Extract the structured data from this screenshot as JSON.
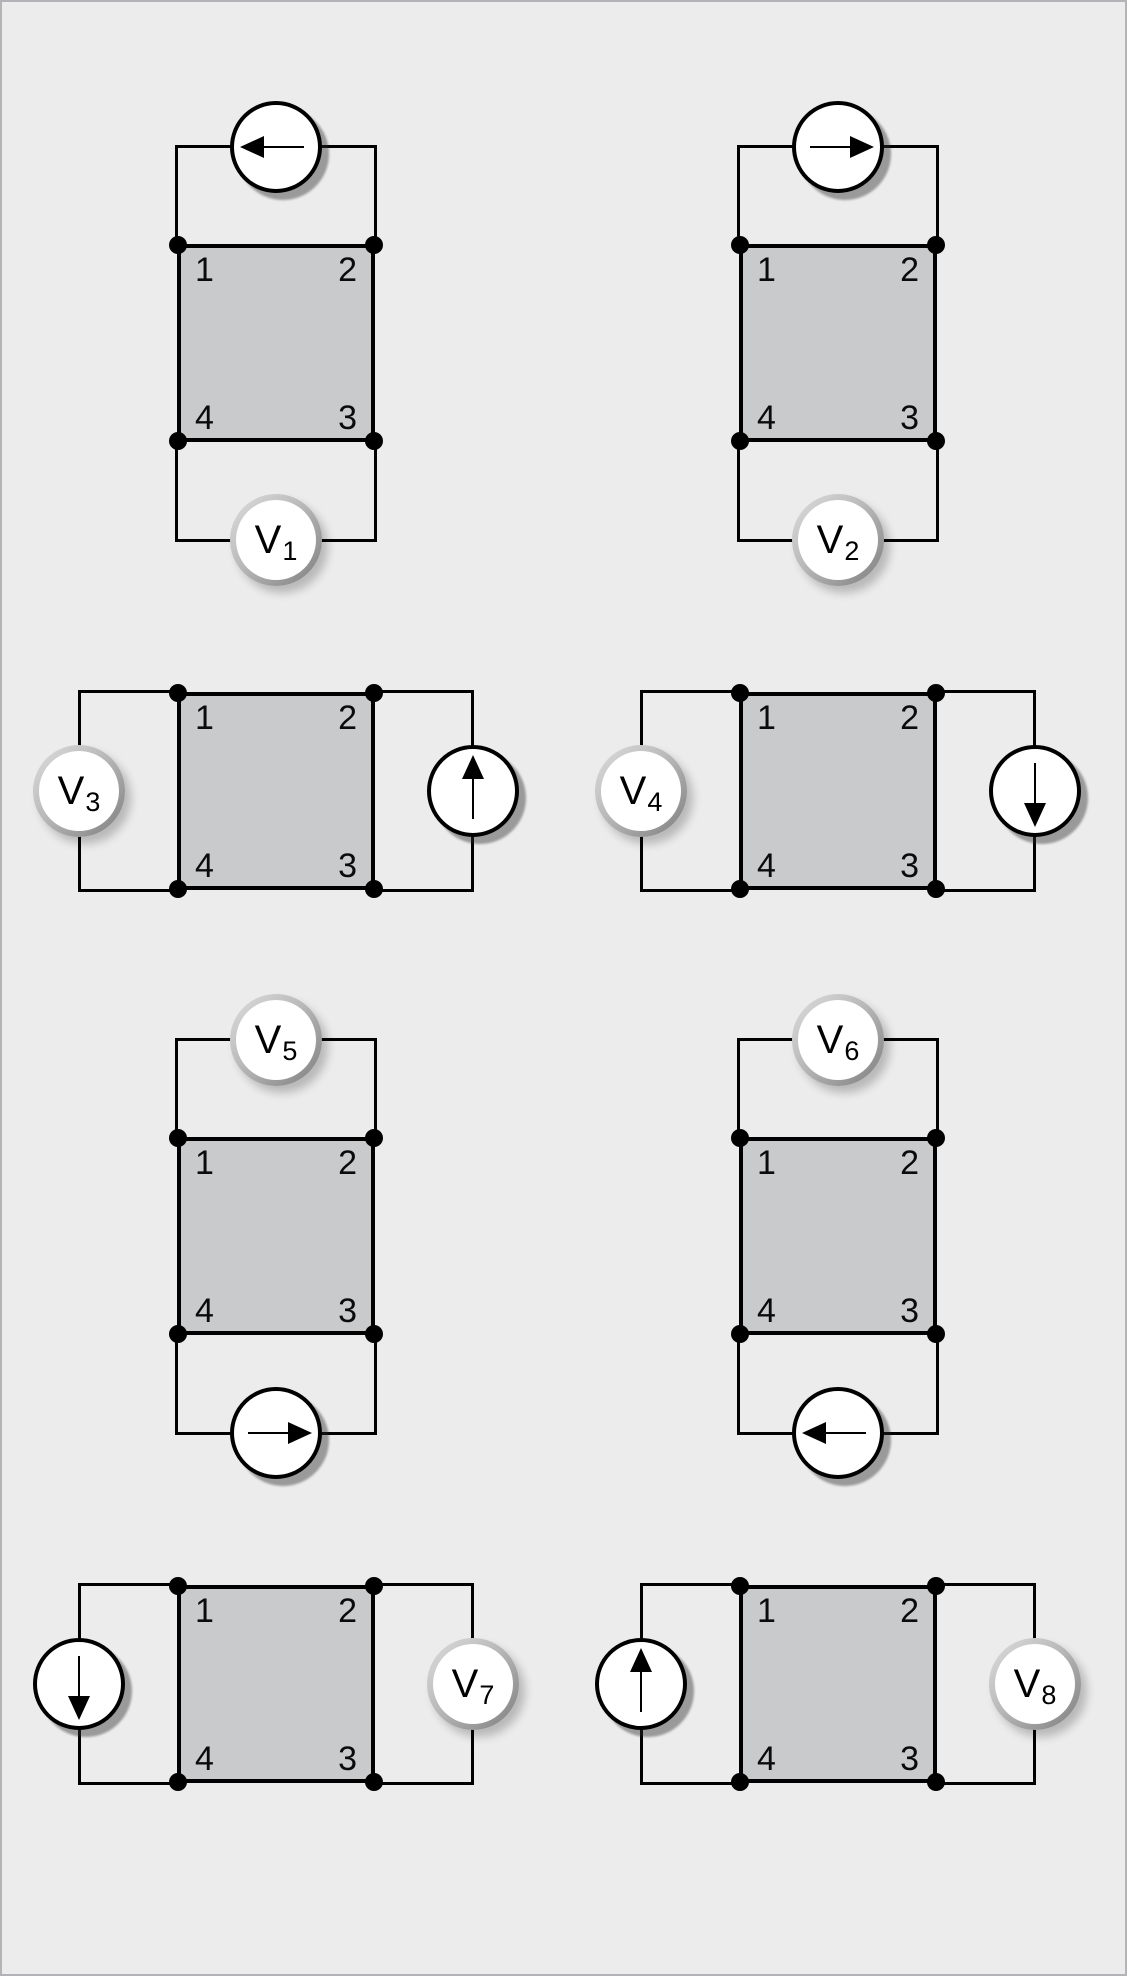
{
  "figure": {
    "type": "van-der-pauw-measurement-configurations",
    "background_color": "#ececec",
    "frame_color": "#b2b4b7",
    "sample_fill_color": "#c9cacb",
    "wire_color": "#000000"
  },
  "diagrams": [
    {
      "name": "config-1",
      "corners": {
        "tl": "1",
        "tr": "2",
        "br": "3",
        "bl": "4"
      },
      "voltmeter": {
        "label": "V",
        "sub": "1",
        "position": "bottom"
      },
      "current_source": {
        "position": "top",
        "arrow_direction": "left"
      }
    },
    {
      "name": "config-2",
      "corners": {
        "tl": "1",
        "tr": "2",
        "br": "3",
        "bl": "4"
      },
      "voltmeter": {
        "label": "V",
        "sub": "2",
        "position": "bottom"
      },
      "current_source": {
        "position": "top",
        "arrow_direction": "right"
      }
    },
    {
      "name": "config-3",
      "corners": {
        "tl": "1",
        "tr": "2",
        "br": "3",
        "bl": "4"
      },
      "voltmeter": {
        "label": "V",
        "sub": "3",
        "position": "left"
      },
      "current_source": {
        "position": "right",
        "arrow_direction": "up"
      }
    },
    {
      "name": "config-4",
      "corners": {
        "tl": "1",
        "tr": "2",
        "br": "3",
        "bl": "4"
      },
      "voltmeter": {
        "label": "V",
        "sub": "4",
        "position": "left"
      },
      "current_source": {
        "position": "right",
        "arrow_direction": "down"
      }
    },
    {
      "name": "config-5",
      "corners": {
        "tl": "1",
        "tr": "2",
        "br": "3",
        "bl": "4"
      },
      "voltmeter": {
        "label": "V",
        "sub": "5",
        "position": "top"
      },
      "current_source": {
        "position": "bottom",
        "arrow_direction": "right"
      }
    },
    {
      "name": "config-6",
      "corners": {
        "tl": "1",
        "tr": "2",
        "br": "3",
        "bl": "4"
      },
      "voltmeter": {
        "label": "V",
        "sub": "6",
        "position": "top"
      },
      "current_source": {
        "position": "bottom",
        "arrow_direction": "left"
      }
    },
    {
      "name": "config-7",
      "corners": {
        "tl": "1",
        "tr": "2",
        "br": "3",
        "bl": "4"
      },
      "voltmeter": {
        "label": "V",
        "sub": "7",
        "position": "right"
      },
      "current_source": {
        "position": "left",
        "arrow_direction": "down"
      }
    },
    {
      "name": "config-8",
      "corners": {
        "tl": "1",
        "tr": "2",
        "br": "3",
        "bl": "4"
      },
      "voltmeter": {
        "label": "V",
        "sub": "8",
        "position": "right"
      },
      "current_source": {
        "position": "left",
        "arrow_direction": "up"
      }
    }
  ]
}
